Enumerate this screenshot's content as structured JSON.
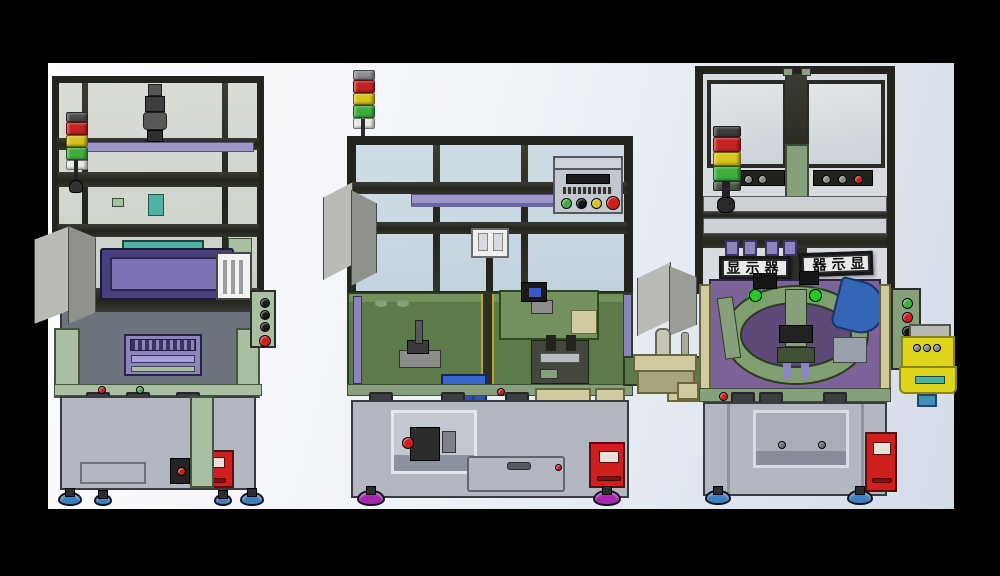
{
  "scene": {
    "description": "CAD rendering of three automated assembly station machines shown side by side, front elevation views on a light studio background with black letterbox borders",
    "machines": [
      {
        "name": "left assembly station with stack light, purple HMI monitor and red drawer"
      },
      {
        "name": "middle assembly station with open enclosure, green work table, pneumatic FRL unit and control button panel"
      },
      {
        "name": "right assembly station with rotary index table, display signs and yellow side unit"
      }
    ]
  },
  "labels": {
    "sign_left": "显示器",
    "sign_right": "显示器"
  },
  "palette": {
    "canvas": "#000000",
    "vpTop": "#fdfdfe",
    "vpBottom": "#d4dcea",
    "frame": "#23241d",
    "glass": "#cfdde6",
    "glassGray": "#d9ddd6",
    "sage": "#a9bfa1",
    "sageDark": "#86a07c",
    "tableGreen": "#5e7a4a",
    "tableLight": "#74905c",
    "slate": "#6e7380",
    "baseGray": "#b3b7c1",
    "recessGray": "#c3c7cf",
    "purpleBar": "#9e95c9",
    "purplePanel": "#7b6299",
    "monFrame": "#47407c",
    "monScreen": "#7b72b4",
    "teal": "#4fb3a4",
    "tray": "#8d83bd",
    "red": "#cf1f1f",
    "orange": "#e8940e",
    "blue": "#2a52b8",
    "blueGuard": "#3565b5",
    "discGreen": "#7f9f70",
    "tan": "#cfcb9f",
    "yellow": "#ded41c",
    "magentaFoot": "#a727ad",
    "blueFoot": "#3d7fc0",
    "towerRed": "#c32222",
    "towerYellow": "#d8c21d",
    "towerGreen": "#3fae3f",
    "signFace": "#e9e9e7",
    "greenLamp": "#28c828"
  }
}
